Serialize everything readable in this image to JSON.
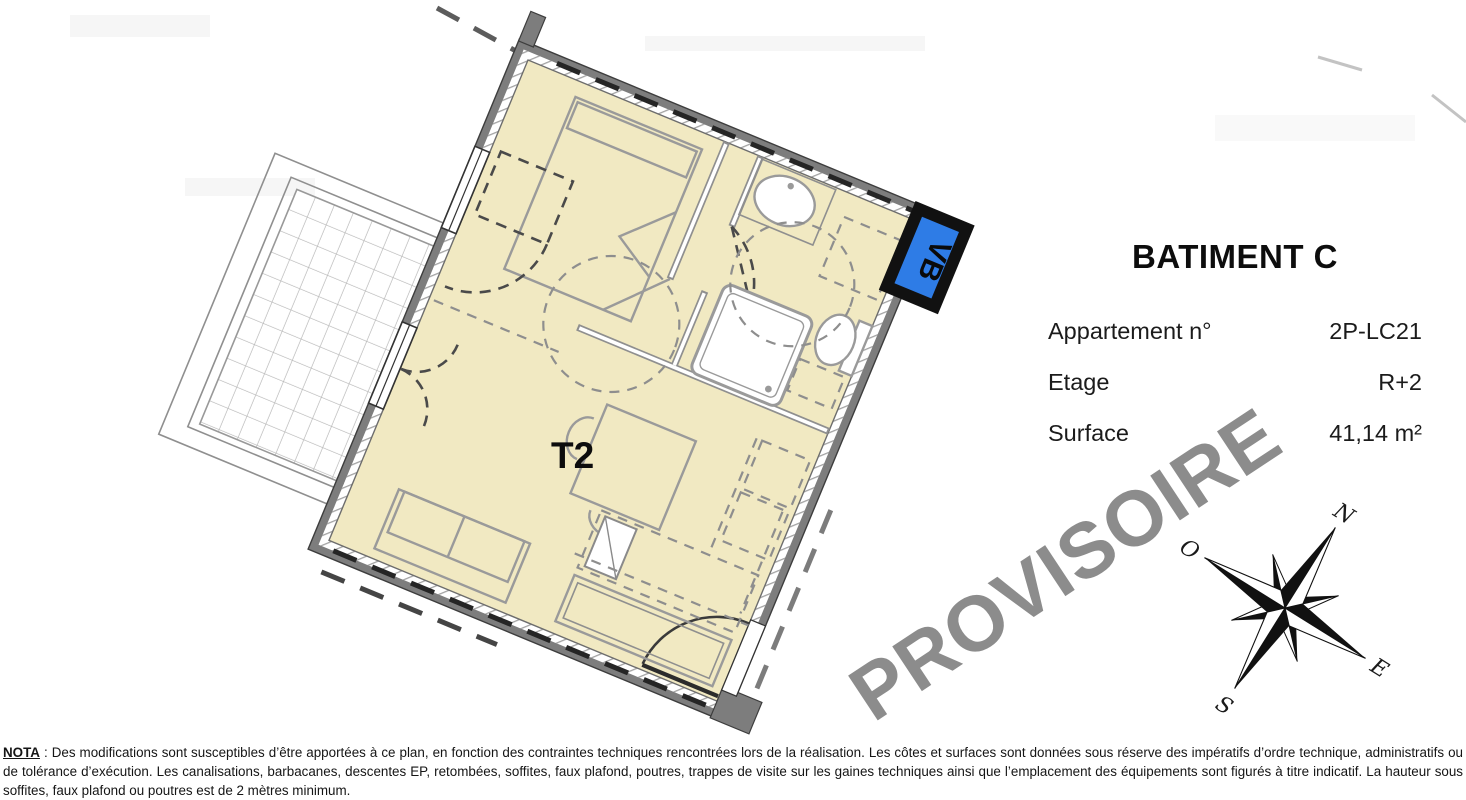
{
  "info_panel": {
    "title": "BATIMENT C",
    "rows": [
      {
        "label": "Appartement n°",
        "value": "2P-LC21"
      },
      {
        "label": "Etage",
        "value": "R+2"
      },
      {
        "label": "Surface",
        "value": "41,14 m²"
      }
    ]
  },
  "plan": {
    "unit_label": "T2",
    "wall_tag": "VB",
    "colors": {
      "floor": "#f1e9c2",
      "wall": "#7d7d7d",
      "vb_blue": "#2e7ce6",
      "watermark_gray": "#8c8c8c"
    }
  },
  "compass": {
    "n": "N",
    "e": "E",
    "s": "S",
    "w": "O"
  },
  "watermark": "PROVISOIRE",
  "nota": {
    "label": "NOTA",
    "text": " : Des modifications sont susceptibles d’être apportées à ce plan, en fonction des contraintes techniques rencontrées lors de la réalisation. Les côtes et surfaces sont données sous réserve des impératifs d’ordre technique, administratifs ou de tolérance d’exécution. Les canalisations, barbacanes, descentes EP, retombées, soffites, faux plafond, poutres, trappes de visite sur les gaines techniques ainsi que l’emplacement des équipements sont figurés à titre indicatif. La hauteur sous soffites, faux plafond ou poutres est de 2 mètres minimum."
  }
}
